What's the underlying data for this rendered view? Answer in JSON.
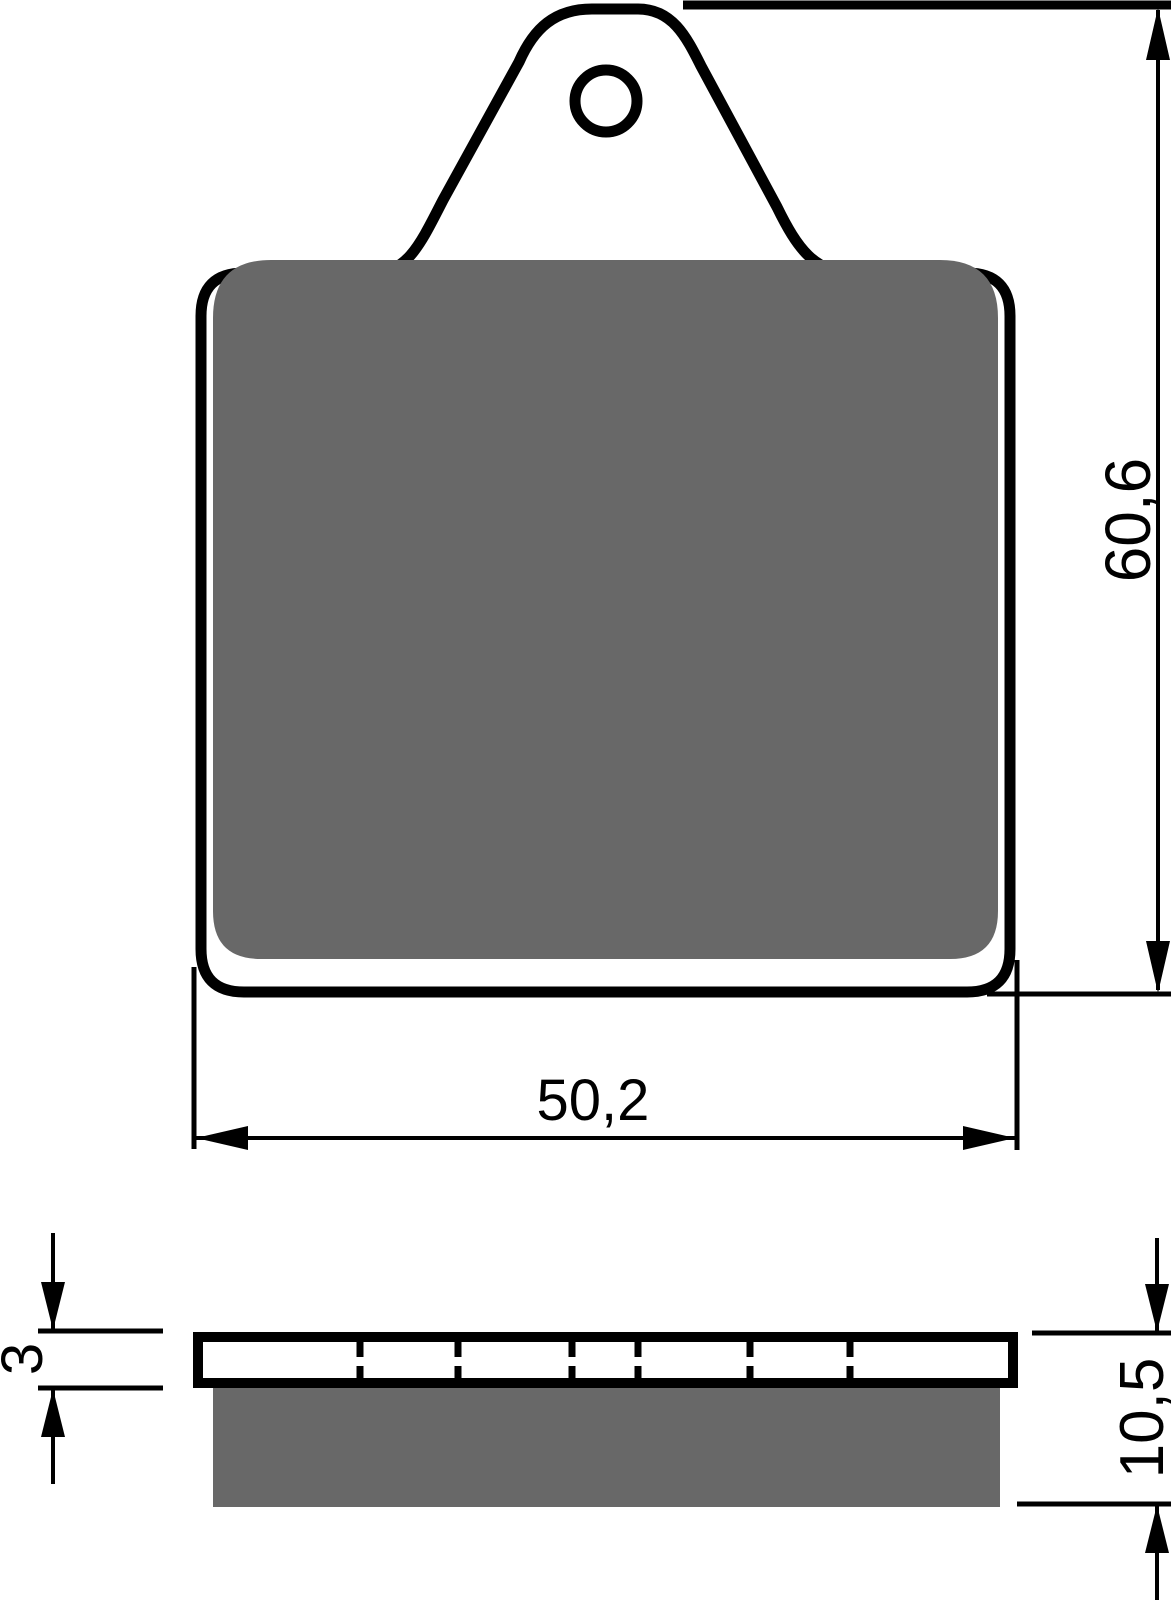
{
  "drawing": {
    "subject": "brake-pad-technical-drawing",
    "background_color": "#ffffff",
    "line_color": "#000000",
    "friction_material_color": "#686868",
    "views": {
      "front_view": {
        "description": "brake pad front profile with top mounting tab and hole",
        "has_mounting_hole": true
      },
      "side_view": {
        "description": "brake pad side section: backing plate with slots and friction material",
        "slot_count": 6,
        "slot_positions_px": [
          360,
          458,
          572,
          638,
          750,
          850
        ]
      }
    },
    "dimensions": {
      "width": {
        "label": "50,2"
      },
      "height": {
        "label": "60,6"
      },
      "plate_thickness": {
        "label": "3"
      },
      "total_thickness": {
        "label": "10,5"
      }
    }
  }
}
